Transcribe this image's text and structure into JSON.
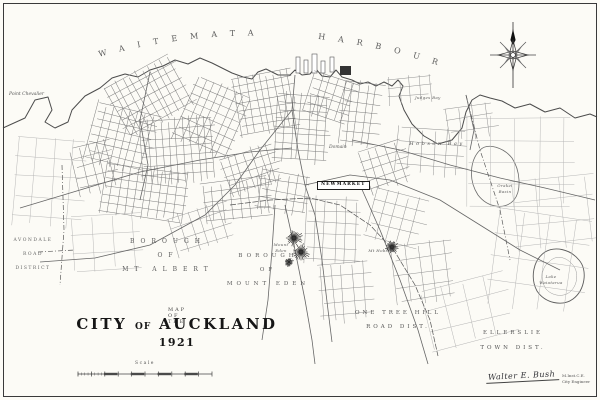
{
  "map": {
    "harbour": {
      "word1": "WAITEMATA",
      "word2": "HARBOUR"
    },
    "labels": {
      "point_chevalier": "Point Chevalier",
      "avondale": [
        "AVONDALE",
        "ROAD",
        "DISTRICT"
      ],
      "mt_albert": [
        "BOROUGH",
        "OF",
        "MT ALBERT"
      ],
      "mt_eden_borough": [
        "BOROUGH",
        "OF",
        "MOUNT EDEN"
      ],
      "one_tree_hill": [
        "ONE TREE HILL",
        "ROAD DIST."
      ],
      "ellerslie": [
        "ELLERSLIE",
        "TOWN DIST."
      ],
      "newmarket": "NEWMARKET",
      "hobson_bay": "Hobson Bay",
      "judges_bay": "Judges Bay",
      "orakei_basin": [
        "Orakei",
        "Basin"
      ],
      "lake_waiatarua": [
        "Lake",
        "Waiatarua"
      ],
      "mount_eden": [
        "Mount",
        "Eden"
      ],
      "mt_hobson": "Mt Hobson",
      "domain": "Domain"
    },
    "title": {
      "prefix": "MAP OF THE",
      "city": "CITY",
      "of": "OF",
      "place": "AUCKLAND",
      "year": "1921",
      "scale": "Scale"
    },
    "signature": {
      "name": "Walter E. Bush",
      "credential": "M.Inst.C.E.",
      "role": "City Engineer"
    }
  }
}
